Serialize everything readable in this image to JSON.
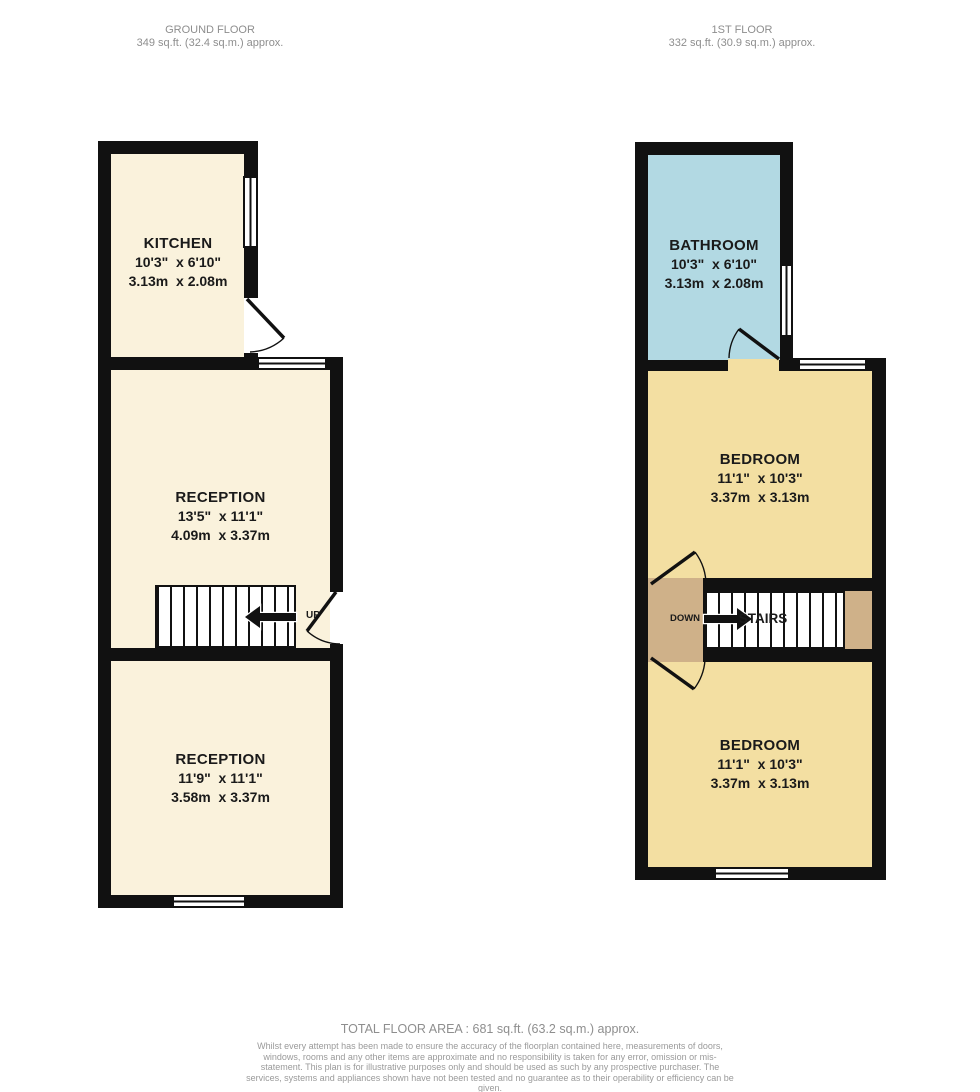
{
  "colors": {
    "wall": "#111111",
    "room_cream": "#faf2dc",
    "room_yellow": "#f3dfa2",
    "room_blue": "#b2d9e3",
    "landing_tan": "#cfb189",
    "header_text": "#8e8e8e",
    "label_text": "#1a1a1a",
    "background": "#ffffff"
  },
  "headers": {
    "ground": {
      "title": "GROUND FLOOR",
      "area": "349 sq.ft. (32.4 sq.m.) approx."
    },
    "first": {
      "title": "1ST FLOOR",
      "area": "332 sq.ft. (30.9 sq.m.) approx."
    }
  },
  "rooms": {
    "kitchen": {
      "name": "KITCHEN",
      "imperial": "10'3\"  x 6'10\"",
      "metric": "3.13m  x 2.08m"
    },
    "reception1": {
      "name": "RECEPTION",
      "imperial": "13'5\"  x 11'1\"",
      "metric": "4.09m  x 3.37m"
    },
    "reception2": {
      "name": "RECEPTION",
      "imperial": "11'9\"  x 11'1\"",
      "metric": "3.58m  x 3.37m"
    },
    "bathroom": {
      "name": "BATHROOM",
      "imperial": "10'3\"  x 6'10\"",
      "metric": "3.13m  x 2.08m"
    },
    "bedroom1": {
      "name": "BEDROOM",
      "imperial": "11'1\"  x 10'3\"",
      "metric": "3.37m  x 3.13m"
    },
    "bedroom2": {
      "name": "BEDROOM",
      "imperial": "11'1\"  x 10'3\"",
      "metric": "3.37m  x 3.13m"
    }
  },
  "stairs": {
    "ground_label": "UP",
    "first_down_label": "DOWN",
    "first_stairs_label": "STAIRS"
  },
  "footer": {
    "total_area": "TOTAL FLOOR AREA : 681 sq.ft. (63.2 sq.m.) approx.",
    "disclaimer": "Whilst every attempt has been made to ensure the accuracy of the floorplan contained here, measurements of doors, windows, rooms and any other items are approximate and no responsibility is taken for any error, omission or mis-statement. This plan is for illustrative purposes only and should be used as such by any prospective purchaser. The services, systems and appliances shown have not been tested and no guarantee as to their operability or efficiency can be given.",
    "credit": "Made with Metropix ©2025"
  }
}
